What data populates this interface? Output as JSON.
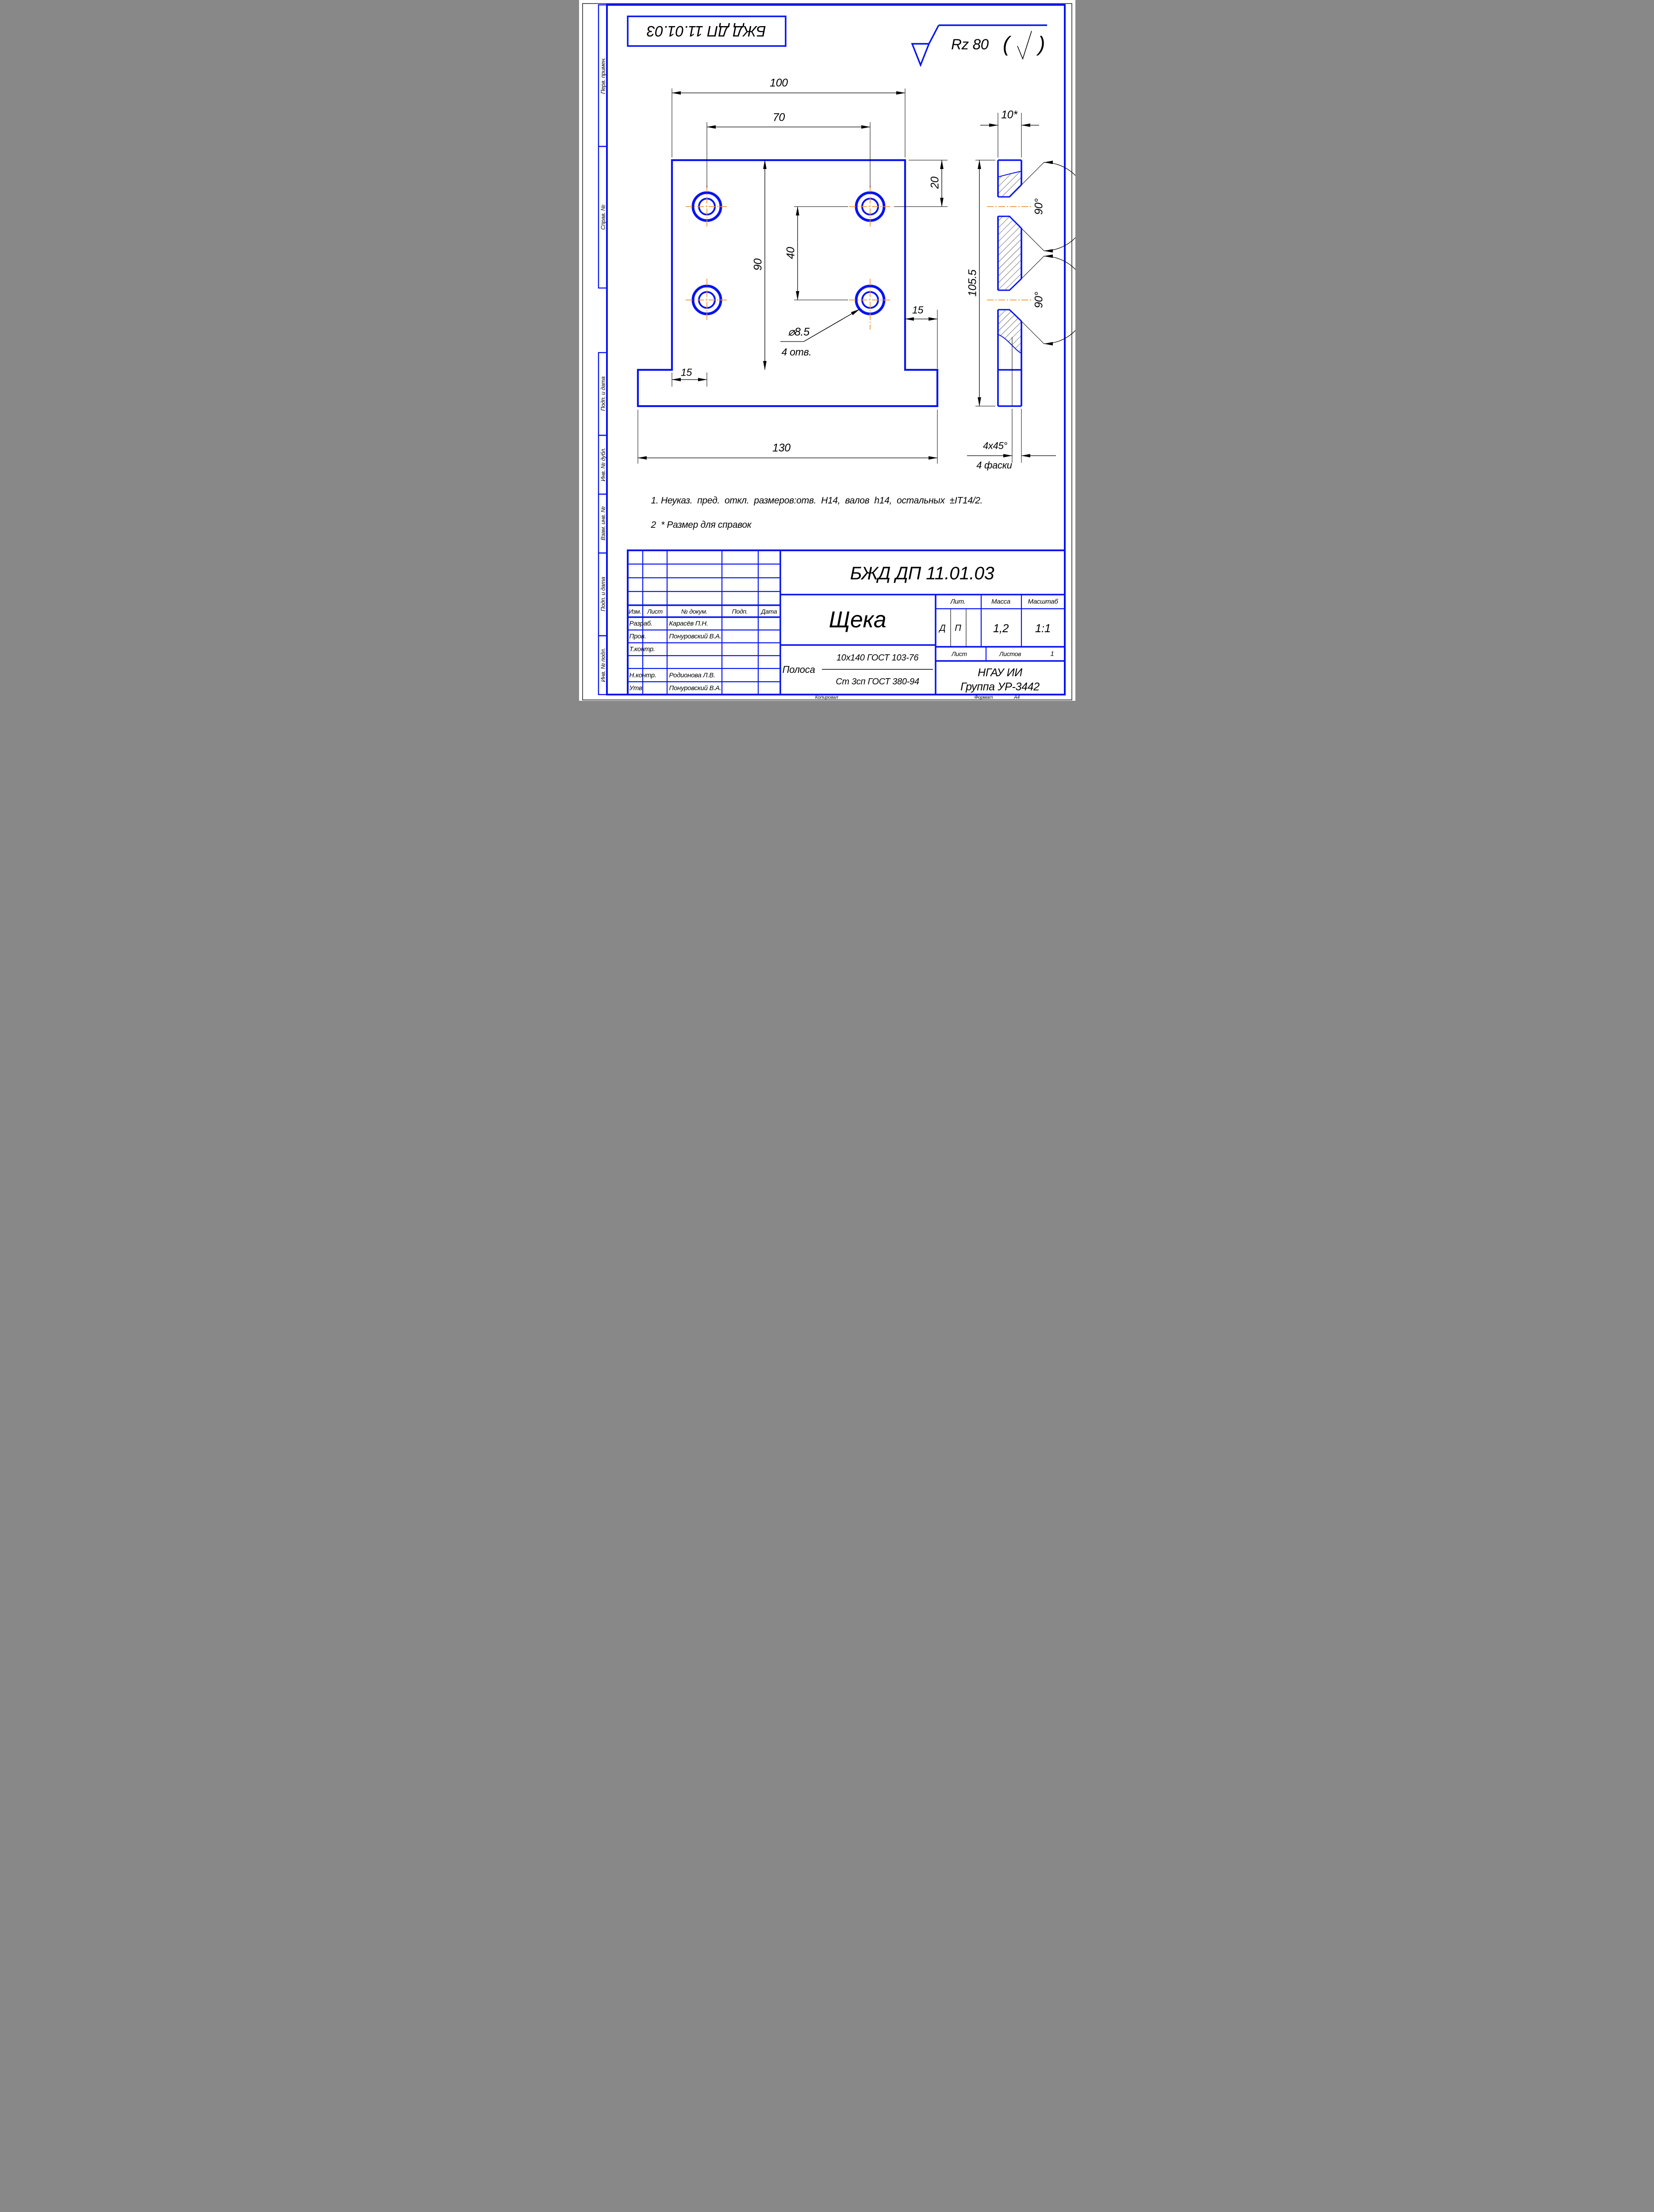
{
  "top_stamp": "БЖД ДП 11.01.03",
  "roughness": {
    "value": "Rz 80",
    "paren_left": "(",
    "paren_right": ")"
  },
  "margin_labels": {
    "perv": "Перв. примен.",
    "sprav": "Справ. №",
    "podp1": "Подп. и дата",
    "inv_dubl": "Инв. № дубл.",
    "vzam": "Взам. инв. №",
    "podp2": "Подп. и дата",
    "inv_podl": "Инв. № подл."
  },
  "front": {
    "d100": "100",
    "d70": "70",
    "d20": "20",
    "d90": "90",
    "d40": "40",
    "d15_right": "15",
    "d15_left": "15",
    "d130": "130",
    "dia": "⌀8.5",
    "holes": "4 отв."
  },
  "side": {
    "d10": "10*",
    "d105": "105.5",
    "a90_top": "90°",
    "a90_bottom": "90°",
    "chamfer": "4x45°",
    "chamfer_note": "4 фаски"
  },
  "notes": {
    "line1": "1. Неуказ.  пред.  откл.  размеров:отв.  Н14,  валов  h14,  остальных  ±IT14/2.",
    "line2": "2  * Размер для справок"
  },
  "title_block": {
    "designation": "БЖД ДП 11.01.03",
    "part_name": "Щека",
    "cols": {
      "izm": "Изм.",
      "list": "Лист",
      "ndoc": "№ докум.",
      "podp": "Подп.",
      "data": "Дата"
    },
    "rows": [
      {
        "role": "Разраб.",
        "name": "Карасёв П.Н."
      },
      {
        "role": "Пров.",
        "name": "Понуровский В.А."
      },
      {
        "role": "Т.контр.",
        "name": ""
      },
      {
        "role": "",
        "name": ""
      },
      {
        "role": "Н.контр.",
        "name": "Родионова Л.В."
      },
      {
        "role": "Утв.",
        "name": "Понуровский В.А."
      }
    ],
    "lit_label": "Лит.",
    "lit1": "Д",
    "lit2": "П",
    "mass_label": "Масса",
    "mass_value": "1,2",
    "scale_label": "Масштаб",
    "scale_value": "1:1",
    "sheet_label": "Лист",
    "sheets_label": "Листов",
    "sheets_value": "1",
    "material_kind": "Полоса",
    "material_top": "10х140 ГОСТ 103-76",
    "material_bottom": "Ст 3сп ГОСТ 380-94",
    "org": "НГАУ ИИ",
    "group": "Группа УР-3442"
  },
  "footer": {
    "copied": "Копировал",
    "format_label": "Формат",
    "format_value": "А4"
  }
}
